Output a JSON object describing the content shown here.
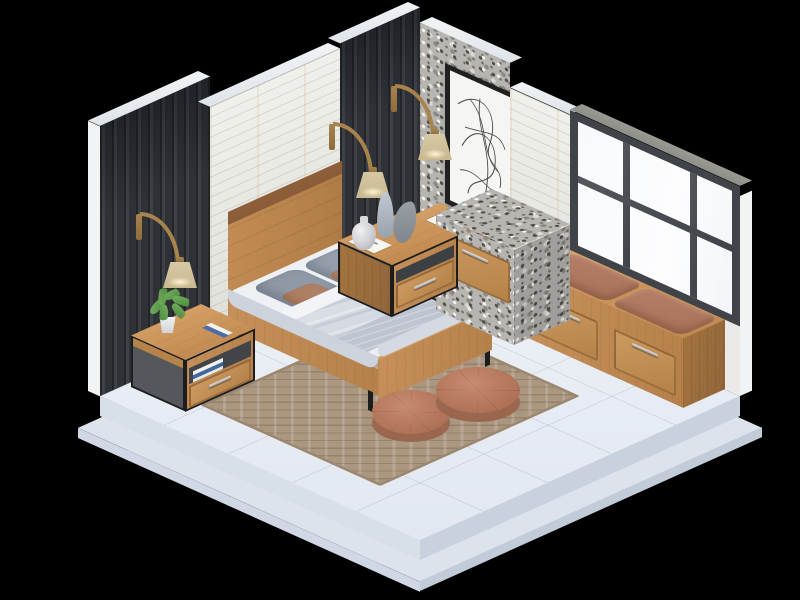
{
  "scene": {
    "title": "Isometric 3D render of a modern bedroom interior on a black background",
    "background": "#000000",
    "colors": {
      "background": "#000000",
      "floor_tile": "#e8edf4",
      "platform_side_dark": "#c8d2df",
      "platform_side_light": "#d7dfe9",
      "wall_slat_dark": "#32363a",
      "wall_brick_white": "#e9eae5",
      "wall_cap_white": "#f2f4f6",
      "terrazzo_gray": "#b7b5b1",
      "window_frame_gray": "#404348",
      "window_cap_gray": "#8f8f89",
      "window_glass_white": "#fdfdfe",
      "wood_oak": "#c08a52",
      "wood_trim_dark": "#8a5c38",
      "metal_frame_black": "#1d1d1d",
      "handle_silver": "#ececec",
      "bedding_sheet_white": "#eef0f4",
      "bedding_duvet_gray": "#ccd2dc",
      "bedding_blanket_gray": "#bec5d1",
      "pillow_gray": "#97a1ad",
      "pillow_tan": "#b5886d",
      "rug_tan": "#ab9680",
      "pouf_terracotta": "#b17459",
      "cushion_brown": "#a8725b",
      "lamp_shade_beige": "#d6c8a5",
      "lamp_arm_wood": "#a9834d",
      "plant_green": "#4e8a3e",
      "art_frame_black": "#202020",
      "art_canvas_white": "#f5f5f2"
    },
    "objects": [
      "raised white tile platform floor",
      "left wall with dark wood slat panels",
      "white ledger-stone wall section behind headboard",
      "terrazzo feature wall with framed abstract line art",
      "white brick pillar",
      "floor-to-ceiling window with dark gray frame",
      "oak double bed with gray layered bedding",
      "two gray pillows and two tan accent pillows",
      "three arc wall lamps with beige shades",
      "left oak nightstand with potted plant and books",
      "two right oak nightstands with vases and magazines",
      "terrazzo vanity counter with oak drawer",
      "window bench with oak drawers and brown leather cushions",
      "diamond-patterned tan area rug",
      "two round terracotta tufted poufs"
    ]
  }
}
